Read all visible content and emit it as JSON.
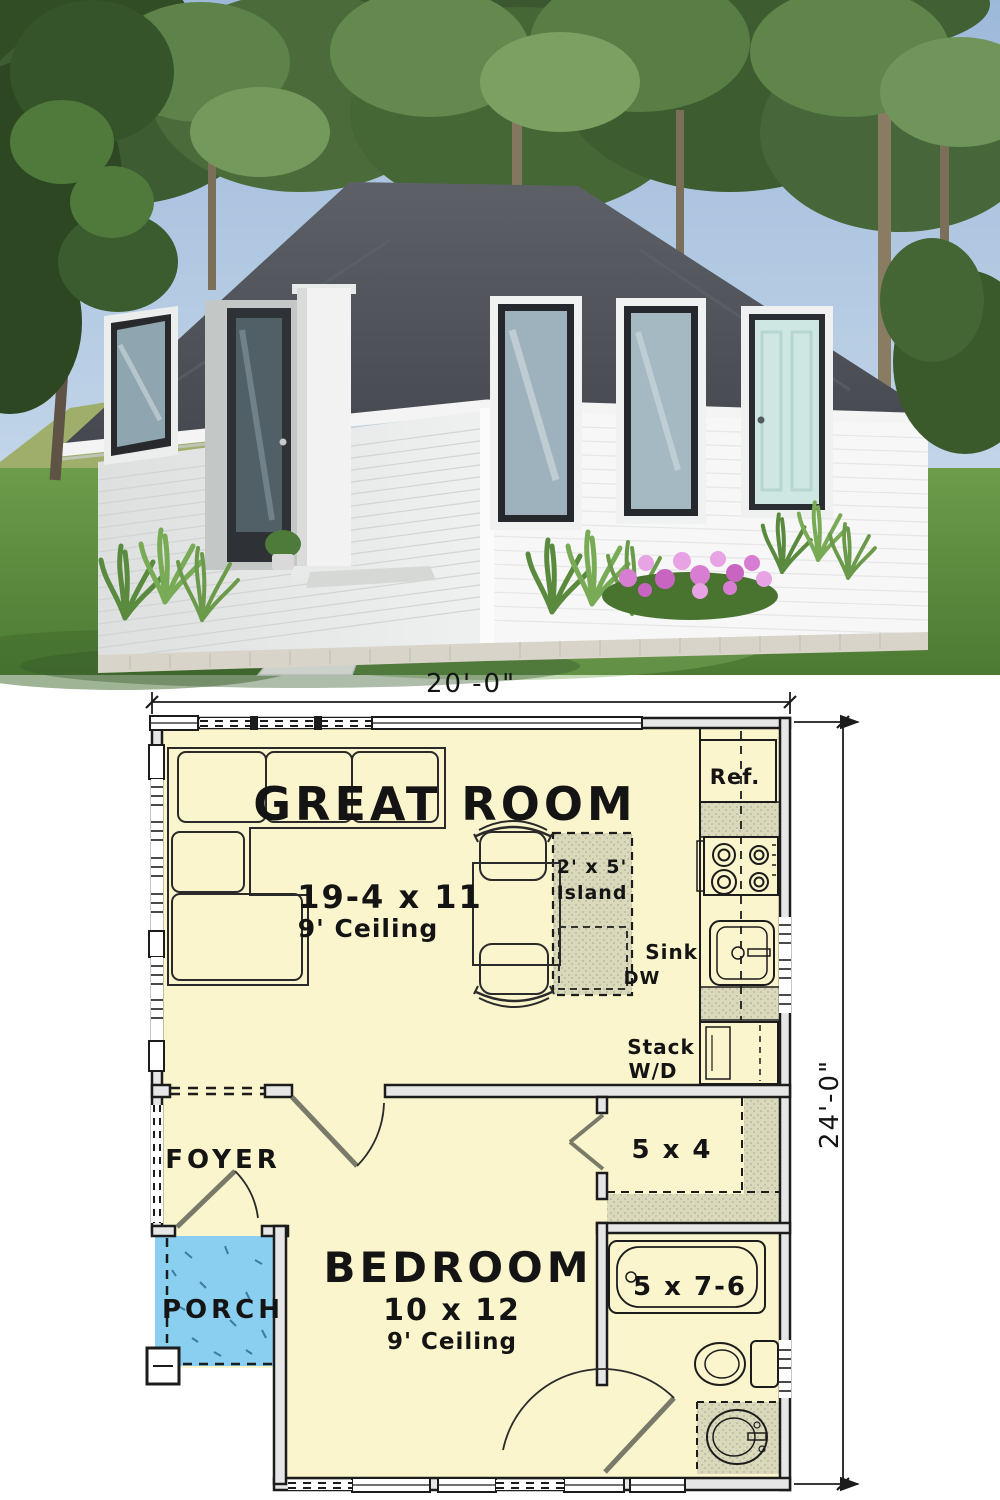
{
  "photo": {
    "description": "3D exterior rendering of a small white hip-roof cottage with dark shingle roof, black-framed windows, a pale teal side door, white corner porch column, concrete walkway, lawn, ornamental grasses, pink flowers and tall background trees"
  },
  "palette": {
    "plan_floor": "#faf5cc",
    "counter_green": "#dbd9bc",
    "porch_blue": "#8acef0",
    "wall_fill": "#e6e6e6",
    "wall_line": "#1c1c1c",
    "roof_gray": "#50545a",
    "door_teal": "#cfe7e3",
    "sky_blue": "#a9c3e0",
    "lawn_green": "#5e8c3f"
  },
  "plan": {
    "dimensions": {
      "width": "20'-0\"",
      "height": "24'-0\""
    },
    "great_room": {
      "name": "GREAT ROOM",
      "size": "19-4 x 11",
      "ceiling": "9' Ceiling"
    },
    "bedroom": {
      "name": "BEDROOM",
      "size": "10 x 12",
      "ceiling": "9' Ceiling"
    },
    "foyer": {
      "label": "FOYER"
    },
    "porch": {
      "label": "PORCH"
    },
    "closet": {
      "size": "5 x 4"
    },
    "bath": {
      "tub_size": "5 x 7-6"
    },
    "kitchen": {
      "fridge": "Ref.",
      "sink": "Sink",
      "dw": "DW",
      "island_size": "2' x 5'",
      "island_label": "Island",
      "laundry1": "Stack",
      "laundry2": "W/D"
    }
  }
}
